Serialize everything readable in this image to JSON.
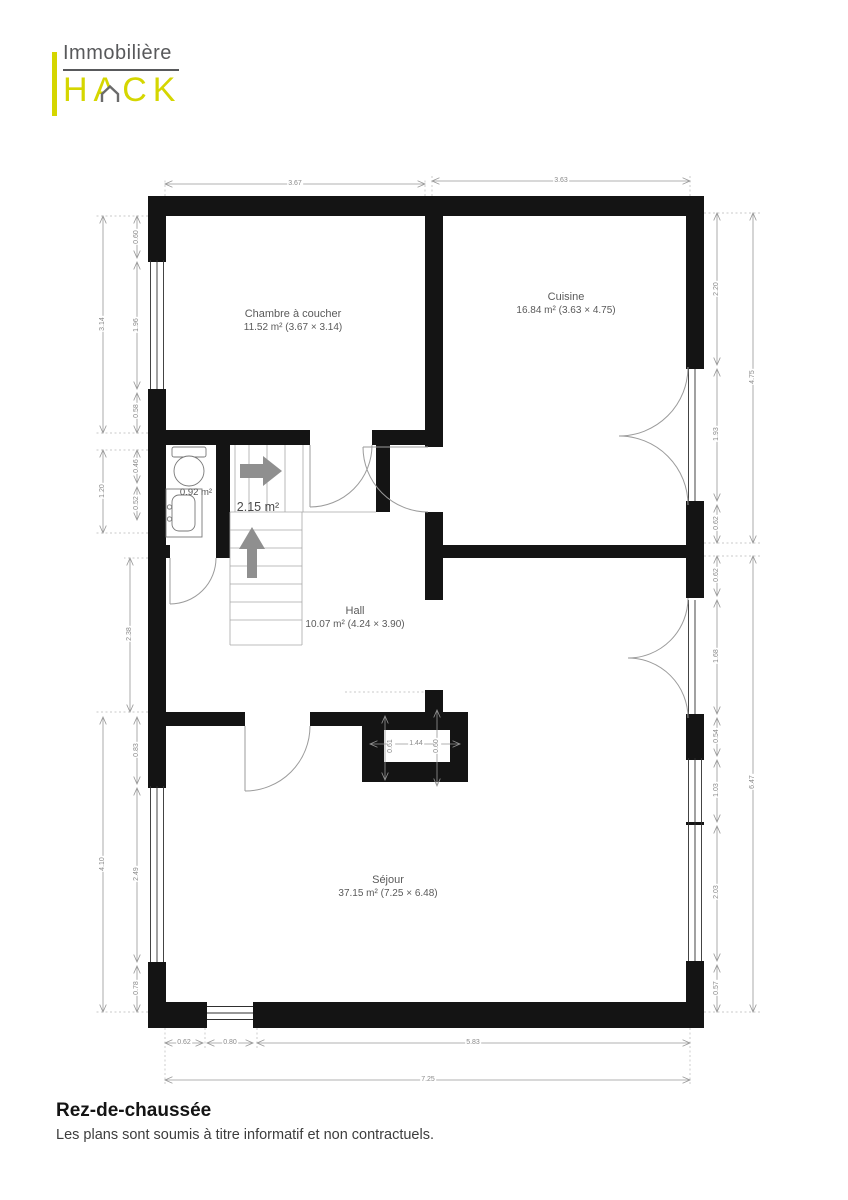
{
  "logo": {
    "line1": "Immobilière",
    "line2": "HACK"
  },
  "colors": {
    "accent": "#d5d600",
    "wall": "#141414",
    "dim_line": "#969696",
    "label": "#5a5a5a"
  },
  "rooms": [
    {
      "id": "chambre",
      "name": "Chambre à coucher",
      "area": "11.52 m²",
      "size": "(3.67 × 3.14)"
    },
    {
      "id": "cuisine",
      "name": "Cuisine",
      "area": "16.84 m²",
      "size": "(3.63 × 4.75)"
    },
    {
      "id": "hall",
      "name": "Hall",
      "area": "10.07 m²",
      "size": "(4.24 × 3.90)"
    },
    {
      "id": "sejour",
      "name": "Séjour",
      "area": "37.15 m²",
      "size": "(7.25 × 6.48)"
    },
    {
      "id": "wc",
      "name": "",
      "area": "0.92 m²",
      "size": ""
    },
    {
      "id": "stairs",
      "name": "",
      "area": "2.15 m²",
      "size": ""
    }
  ],
  "dimensions": [
    {
      "v": "3.67",
      "x": 295,
      "y": 184,
      "rot": false
    },
    {
      "v": "3.63",
      "x": 561,
      "y": 181,
      "rot": false
    },
    {
      "v": "3.14",
      "x": 103,
      "y": 324,
      "rot": true
    },
    {
      "v": "0.60",
      "x": 137,
      "y": 237,
      "rot": true
    },
    {
      "v": "1.96",
      "x": 137,
      "y": 325,
      "rot": true
    },
    {
      "v": "0.58",
      "x": 137,
      "y": 411,
      "rot": true
    },
    {
      "v": "1.20",
      "x": 103,
      "y": 491,
      "rot": true
    },
    {
      "v": "0.46",
      "x": 137,
      "y": 466,
      "rot": true
    },
    {
      "v": "0.52",
      "x": 137,
      "y": 503,
      "rot": true
    },
    {
      "v": "2.38",
      "x": 130,
      "y": 634,
      "rot": true
    },
    {
      "v": "4.10",
      "x": 103,
      "y": 864,
      "rot": true
    },
    {
      "v": "0.83",
      "x": 137,
      "y": 750,
      "rot": true
    },
    {
      "v": "2.49",
      "x": 137,
      "y": 874,
      "rot": true
    },
    {
      "v": "0.78",
      "x": 137,
      "y": 988,
      "rot": true
    },
    {
      "v": "2.20",
      "x": 717,
      "y": 289,
      "rot": true
    },
    {
      "v": "1.93",
      "x": 717,
      "y": 434,
      "rot": true
    },
    {
      "v": "0.62",
      "x": 717,
      "y": 523,
      "rot": true
    },
    {
      "v": "4.75",
      "x": 753,
      "y": 377,
      "rot": true
    },
    {
      "v": "0.62",
      "x": 717,
      "y": 575,
      "rot": true
    },
    {
      "v": "1.68",
      "x": 717,
      "y": 656,
      "rot": true
    },
    {
      "v": "0.54",
      "x": 717,
      "y": 736,
      "rot": true
    },
    {
      "v": "1.03",
      "x": 717,
      "y": 790,
      "rot": true
    },
    {
      "v": "2.03",
      "x": 717,
      "y": 892,
      "rot": true
    },
    {
      "v": "0.57",
      "x": 717,
      "y": 988,
      "rot": true
    },
    {
      "v": "6.47",
      "x": 753,
      "y": 782,
      "rot": true
    },
    {
      "v": "0.62",
      "x": 184,
      "y": 1043,
      "rot": false
    },
    {
      "v": "0.80",
      "x": 230,
      "y": 1043,
      "rot": false
    },
    {
      "v": "5.83",
      "x": 473,
      "y": 1043,
      "rot": false
    },
    {
      "v": "7.25",
      "x": 428,
      "y": 1080,
      "rot": false
    },
    {
      "v": "1.44",
      "x": 416,
      "y": 744,
      "rot": false
    },
    {
      "v": "0.61",
      "x": 391,
      "y": 746,
      "rot": true
    },
    {
      "v": "0.60",
      "x": 437,
      "y": 746,
      "rot": true
    }
  ],
  "footer": {
    "title": "Rez-de-chaussée",
    "disclaimer": "Les plans sont soumis à titre informatif et non contractuels."
  }
}
